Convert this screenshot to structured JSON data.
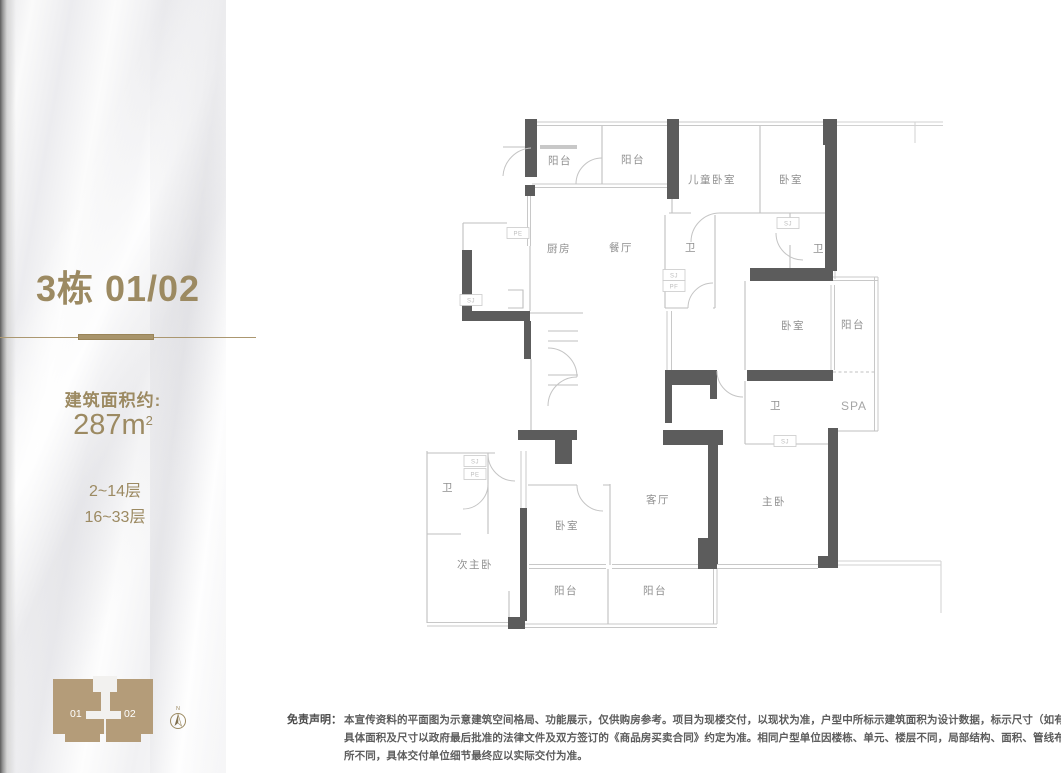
{
  "sidebar": {
    "unit_title": "3栋 01/02",
    "area_label": "建筑面积约:",
    "area_value": "287m",
    "area_superscript": "2",
    "floors": [
      "2~14层",
      "16~33层"
    ],
    "accent_color": "#9c8a62"
  },
  "building_diagram": {
    "unit_left": "01",
    "unit_right": "02",
    "compass_label": "N",
    "fill_color": "#b49c79"
  },
  "floorplan": {
    "rooms": [
      {
        "label": "阳台",
        "x": 165,
        "y": 51
      },
      {
        "label": "阳台",
        "x": 238,
        "y": 50
      },
      {
        "label": "儿童卧室",
        "x": 317,
        "y": 70
      },
      {
        "label": "卧室",
        "x": 396,
        "y": 70
      },
      {
        "label": "厨房",
        "x": 164,
        "y": 139
      },
      {
        "label": "餐厅",
        "x": 226,
        "y": 138
      },
      {
        "label": "卫",
        "x": 296,
        "y": 138
      },
      {
        "label": "卫",
        "x": 424,
        "y": 139
      },
      {
        "label": "卧室",
        "x": 398,
        "y": 216
      },
      {
        "label": "阳台",
        "x": 458,
        "y": 215
      },
      {
        "label": "卫",
        "x": 381,
        "y": 296
      },
      {
        "label": "SPA",
        "x": 459,
        "y": 297,
        "cls": "spa"
      },
      {
        "label": "卫",
        "x": 53,
        "y": 378
      },
      {
        "label": "客厅",
        "x": 263,
        "y": 390
      },
      {
        "label": "主卧",
        "x": 379,
        "y": 392
      },
      {
        "label": "卧室",
        "x": 172,
        "y": 416
      },
      {
        "label": "次主卧",
        "x": 80,
        "y": 455
      },
      {
        "label": "阳台",
        "x": 171,
        "y": 481
      },
      {
        "label": "阳台",
        "x": 260,
        "y": 481
      }
    ],
    "shafts": [
      {
        "label": "PE",
        "x": 123,
        "y": 120
      },
      {
        "label": "SJ",
        "x": 76,
        "y": 187
      },
      {
        "label": "SJ",
        "x": 393,
        "y": 110
      },
      {
        "label": "SJ",
        "x": 279,
        "y": 162
      },
      {
        "label": "PF",
        "x": 279,
        "y": 173
      },
      {
        "label": "SJ",
        "x": 390,
        "y": 328
      },
      {
        "label": "SJ",
        "x": 80,
        "y": 348
      },
      {
        "label": "PE",
        "x": 80,
        "y": 361
      }
    ]
  },
  "disclaimer": {
    "label": "免责声明：",
    "lines": [
      "本宣传资料的平面图为示意建筑空间格局、功能展示，仅供购房参考。项目为现楼交付，以现状为准，户型中所标示建筑面积为设计数据，标示尺寸（如有）仅供参考，",
      "具体面积及尺寸以政府最后批准的法律文件及双方签订的《商品房买卖合同》约定为准。相同户型单位因楼栋、单元、楼层不同，局部结构、面积、管线布置等均可能有",
      "所不同，具体交付单位细节最终应以实际交付为准。"
    ]
  }
}
